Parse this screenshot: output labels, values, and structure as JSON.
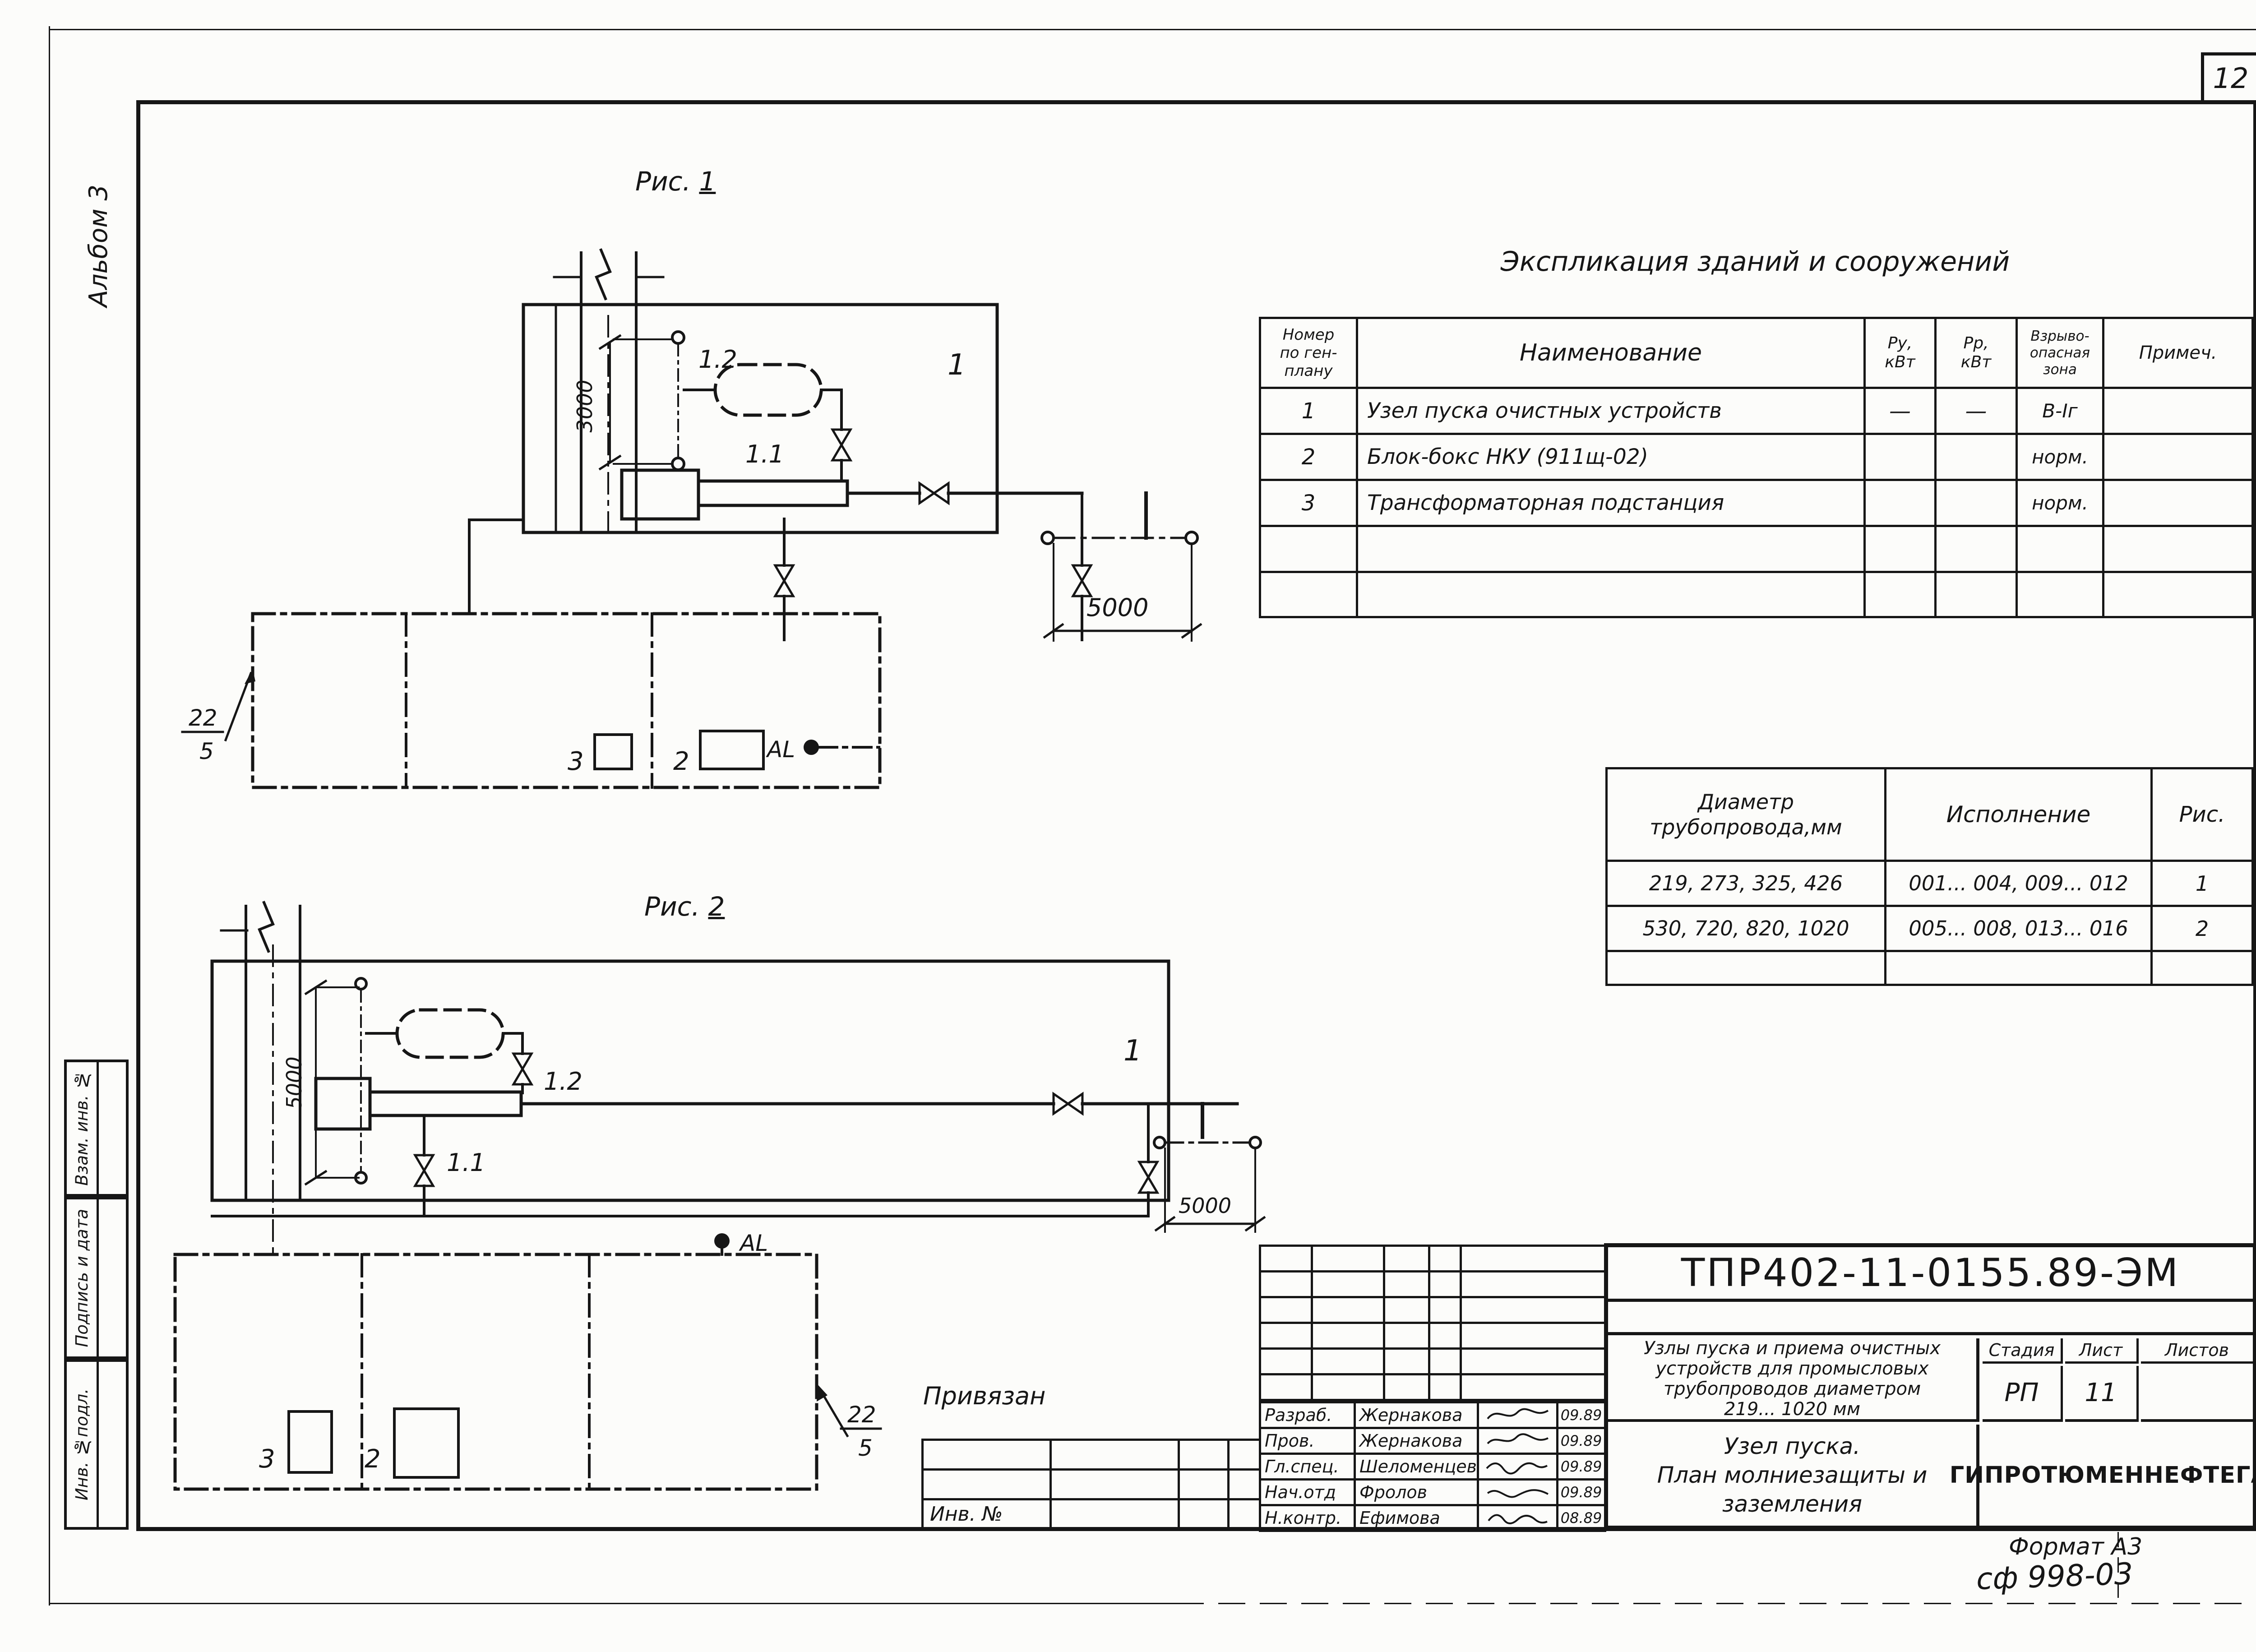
{
  "page": {
    "sheet_number": "12",
    "album_label": "Альбом 3",
    "format_label": "Формат А3",
    "microfilm_code": "сф 998-03",
    "attached_label": "Привязан",
    "inv_label": "Инв. №"
  },
  "side_stamp": {
    "vzam": "Взам. инв. №",
    "podpis": "Подпись и дата",
    "inv_podl": "Инв. №подл."
  },
  "explication": {
    "title": "Экспликация зданий и сооружений",
    "headers": {
      "num": [
        "Номер",
        "по ген-",
        "плану"
      ],
      "name": "Наименование",
      "pu": [
        "Ру,",
        "кВт"
      ],
      "pp": [
        "Рр,",
        "кВт"
      ],
      "zone": [
        "Взрыво-",
        "опасная",
        "зона"
      ],
      "note": "Примеч."
    },
    "rows": [
      {
        "num": "1",
        "name": "Узел пуска очистных устройств",
        "pu": "—",
        "pp": "—",
        "zone": "В-Iг",
        "note": ""
      },
      {
        "num": "2",
        "name": "Блок-бокс НКУ (911щ-02)",
        "pu": "",
        "pp": "",
        "zone": "норм.",
        "note": ""
      },
      {
        "num": "3",
        "name": "Трансформаторная подстанция",
        "pu": "",
        "pp": "",
        "zone": "норм.",
        "note": ""
      }
    ]
  },
  "diameters": {
    "headers": {
      "d": [
        "Диаметр",
        "трубопровода,мм"
      ],
      "exec": "Исполнение",
      "fig": "Рис."
    },
    "rows": [
      {
        "d": "219, 273, 325, 426",
        "exec": "001... 004, 009... 012",
        "fig": "1"
      },
      {
        "d": "530, 720, 820, 1020",
        "exec": "005... 008, 013... 016",
        "fig": "2"
      }
    ]
  },
  "fig1": {
    "caption": "Рис.",
    "caption_num": "1",
    "building_tag": "1",
    "vent_tag": "1.2",
    "launcher_tag": "1.1",
    "dim_vertical": "3000",
    "dim_horizontal": "5000",
    "plan": {
      "callout_top": "22",
      "callout_bottom": "5",
      "item3": "3",
      "item2": "2",
      "al": "AL"
    }
  },
  "fig2": {
    "caption": "Рис.",
    "caption_num": "2",
    "building_tag": "1",
    "vent_tag": "1.2",
    "launcher_tag": "1.1",
    "dim_vertical": "5000",
    "dim_horizontal": "5000",
    "plan": {
      "callout_top": "22",
      "callout_bottom": "5",
      "item3": "3",
      "item2": "2",
      "al": "AL"
    }
  },
  "title_block": {
    "code": "ТПР402-11-0155.89-ЭМ",
    "project_lines": [
      "Узлы пуска и приема очистных",
      "устройств для промысловых",
      "трубопроводов диаметром",
      "219... 1020 мм"
    ],
    "sheet_name_lines": [
      "Узел пуска.",
      "План молниезащиты и",
      "заземления"
    ],
    "organization": "ГИПРОТЮМЕННЕФТЕГАЗ",
    "stage_label": "Стадия",
    "list_label": "Лист",
    "lists_label": "Листов",
    "stage_value": "РП",
    "list_value": "11",
    "lists_value": "",
    "signatures": [
      {
        "role": "Разраб.",
        "name": "Жернакова",
        "date": "09.89"
      },
      {
        "role": "Пров.",
        "name": "Жернакова",
        "date": "09.89"
      },
      {
        "role": "Гл.спец.",
        "name": "Шеломенцев",
        "date": "09.89"
      },
      {
        "role": "Нач.отд",
        "name": "Фролов",
        "date": "09.89"
      },
      {
        "role": "Н.контр.",
        "name": "Ефимова",
        "date": "08.89"
      }
    ]
  }
}
